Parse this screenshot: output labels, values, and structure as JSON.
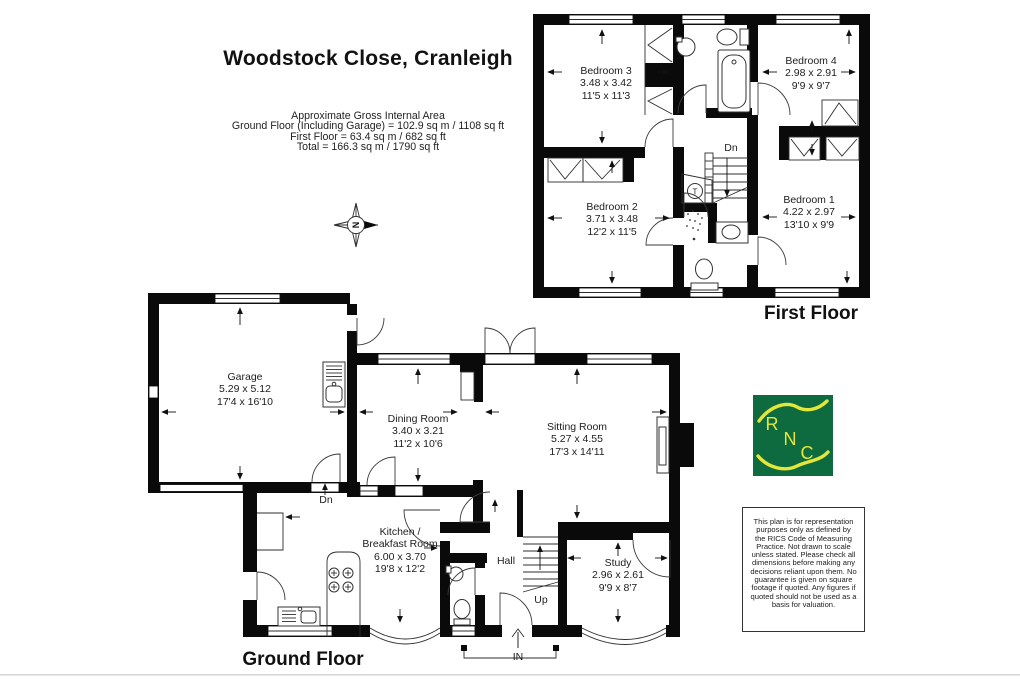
{
  "title": "Woodstock Close, Cranleigh",
  "area_summary": {
    "heading": "Approximate Gross Internal Area",
    "line1": "Ground Floor (Including Garage) = 102.9 sq m / 1108 sq ft",
    "line2": "First Floor = 63.4 sq m / 682 sq ft",
    "line3": "Total = 166.3 sq m / 1790 sq ft"
  },
  "compass": {
    "north_label": "N"
  },
  "first_floor": {
    "label": "First Floor",
    "stairs_label": "Dn",
    "tank_label": "T",
    "rooms": [
      {
        "name": "Bedroom 3",
        "metric": "3.48 x 3.42",
        "imperial": "11'5 x 11'3"
      },
      {
        "name": "Bedroom 4",
        "metric": "2.98 x 2.91",
        "imperial": "9'9 x 9'7"
      },
      {
        "name": "Bedroom 2",
        "metric": "3.71 x 3.48",
        "imperial": "12'2 x 11'5"
      },
      {
        "name": "Bedroom 1",
        "metric": "4.22 x 2.97",
        "imperial": "13'10 x 9'9"
      }
    ]
  },
  "ground_floor": {
    "label": "Ground Floor",
    "hall_label": "Hall",
    "stairs_label": "Up",
    "entrance_label": "IN",
    "garage_step_label": "Dn",
    "rooms": [
      {
        "name": "Garage",
        "metric": "5.29 x 5.12",
        "imperial": "17'4 x 16'10"
      },
      {
        "name": "Dining Room",
        "metric": "3.40 x 3.21",
        "imperial": "11'2 x 10'6"
      },
      {
        "name": "Sitting Room",
        "metric": "5.27 x 4.55",
        "imperial": "17'3 x 14'11"
      },
      {
        "name_line1": "Kitchen /",
        "name_line2": "Breakfast Room",
        "metric": "6.00 x 3.70",
        "imperial": "19'8 x 12'2"
      },
      {
        "name": "Study",
        "metric": "2.96 x 2.61",
        "imperial": "9'9 x 8'7"
      }
    ]
  },
  "logo": {
    "letter1": "R",
    "letter2": "N",
    "letter3": "C",
    "bg_color": "#0d6b3f",
    "fg_color": "#e4e73a"
  },
  "disclaimer": "This plan is for representation purposes only as defined by the RICS Code of Measuring Practice. Not drawn to scale unless stated. Please check all dimensions before making any decisions reliant upon them. No guarantee is given on square footage if quoted. Any figures if quoted should not be used as a basis for valuation."
}
